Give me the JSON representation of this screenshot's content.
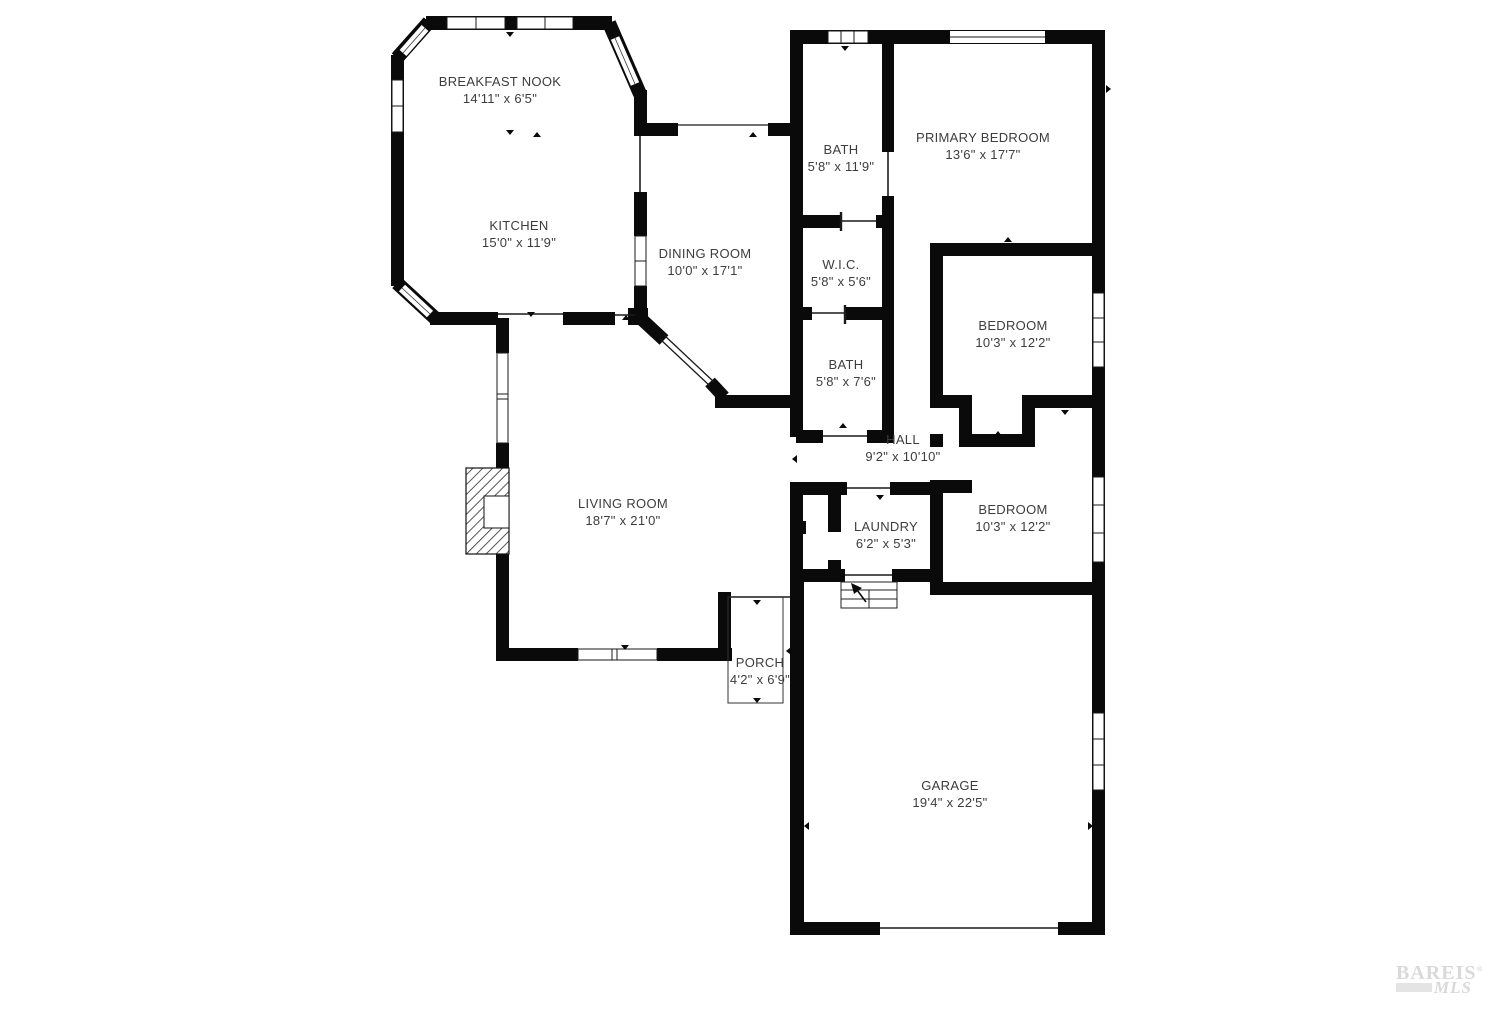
{
  "rooms": [
    {
      "id": "breakfast-nook",
      "name": "BREAKFAST NOOK",
      "dims": "14'11\" x 6'5\""
    },
    {
      "id": "kitchen",
      "name": "KITCHEN",
      "dims": "15'0\" x 11'9\""
    },
    {
      "id": "dining-room",
      "name": "DINING ROOM",
      "dims": "10'0\" x 17'1\""
    },
    {
      "id": "bath-1",
      "name": "BATH",
      "dims": "5'8\" x 11'9\""
    },
    {
      "id": "primary-bedroom",
      "name": "PRIMARY BEDROOM",
      "dims": "13'6\" x 17'7\""
    },
    {
      "id": "wic",
      "name": "W.I.C.",
      "dims": "5'8\" x 5'6\""
    },
    {
      "id": "bath-2",
      "name": "BATH",
      "dims": "5'8\" x 7'6\""
    },
    {
      "id": "bedroom-1",
      "name": "BEDROOM",
      "dims": "10'3\" x 12'2\""
    },
    {
      "id": "hall",
      "name": "HALL",
      "dims": "9'2\" x 10'10\""
    },
    {
      "id": "bedroom-2",
      "name": "BEDROOM",
      "dims": "10'3\" x 12'2\""
    },
    {
      "id": "living-room",
      "name": "LIVING ROOM",
      "dims": "18'7\" x 21'0\""
    },
    {
      "id": "laundry",
      "name": "LAUNDRY",
      "dims": "6'2\" x 5'3\""
    },
    {
      "id": "porch",
      "name": "PORCH",
      "dims": "4'2\" x 6'9\""
    },
    {
      "id": "garage",
      "name": "GARAGE",
      "dims": "19'4\" x 22'5\""
    }
  ],
  "watermark": {
    "brand": "BAREIS",
    "reg": "®",
    "mls": "MLS"
  },
  "colors": {
    "wall": "#0a0a0a",
    "thin": "#1a1a1a",
    "label": "#3d3d3d",
    "watermark": "#d9d9d9"
  }
}
